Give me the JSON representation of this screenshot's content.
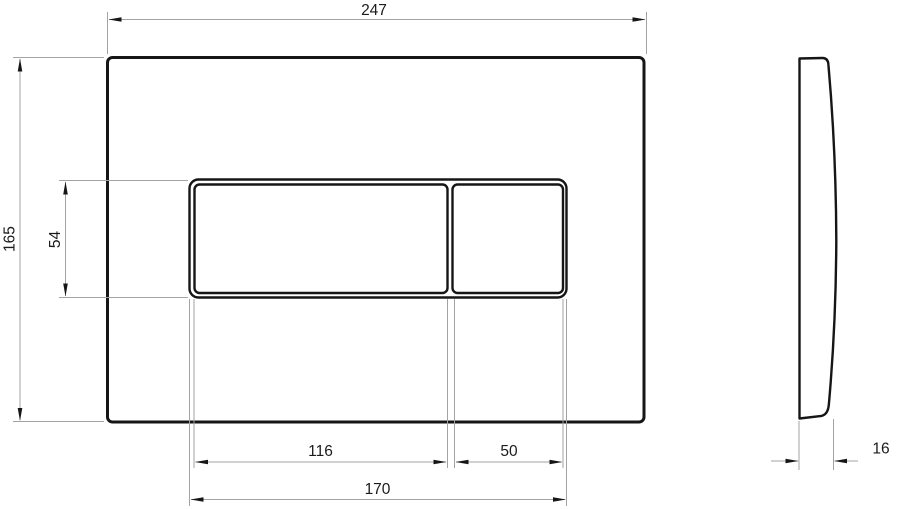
{
  "dimensions": {
    "plate_width": "247",
    "plate_height": "165",
    "button_area_height": "54",
    "large_button_width": "116",
    "small_button_width": "50",
    "button_area_width": "170",
    "plate_thickness": "16"
  },
  "colors": {
    "outline": "#161616",
    "dimension_line": "#a3a3a3",
    "arrow": "#161616",
    "label_text": "#1b1b1b",
    "background": "#ffffff"
  }
}
